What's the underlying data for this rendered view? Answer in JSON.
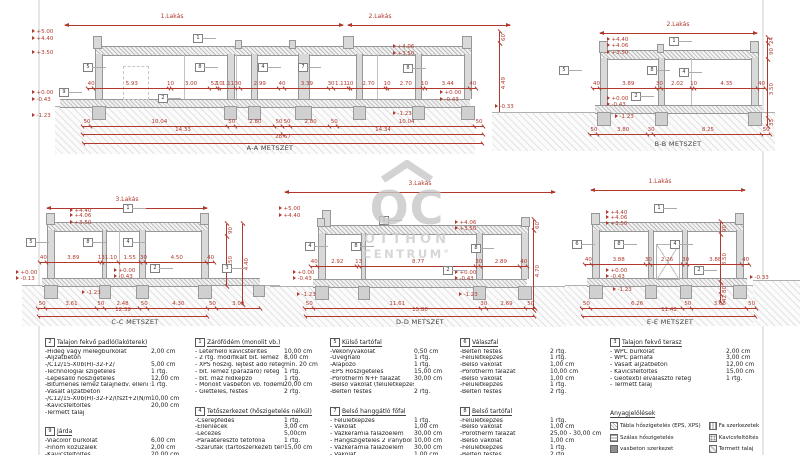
{
  "watermark": {
    "monogram": "OC",
    "line1": "OTTHON",
    "line2": "CENTRUM",
    "reg": "®"
  },
  "sections": {
    "aa": {
      "title": "A-A METSZET",
      "span1": "1.Lakás",
      "span2": "2.Lakás",
      "dims_main": [
        "40",
        "5.93",
        "10",
        "3.00",
        "52",
        "10",
        "1.11",
        "30",
        "2.99",
        "40",
        "3.39",
        "30",
        "1.11",
        "10",
        "2.70",
        "10",
        "2.70",
        "10",
        "3.44",
        "40"
      ],
      "dims_b1": [
        "50",
        "10.04",
        "50",
        "2.80",
        "50",
        "50",
        "2.80",
        "50",
        "10.04",
        "50"
      ],
      "dims_b2": [
        "14.33",
        "14.34"
      ],
      "total": "28.67",
      "vdims": [
        "60",
        "4.49",
        "70",
        "51"
      ],
      "elevs": [
        "+5.00",
        "+4.40",
        "+3.50",
        "+0.00",
        "-0.43",
        "-1.23",
        "+4.06",
        "+3.50",
        "+0.00",
        "-0.43",
        "-1.23"
      ],
      "callouts": [
        "1",
        "5",
        "8",
        "4",
        "7",
        "8",
        "2",
        "9"
      ]
    },
    "bb": {
      "title": "B-B METSZET",
      "span": "2.Lakás",
      "dims_main": [
        "40",
        "3.89",
        "30",
        "2.02",
        "10",
        "4.35",
        "40"
      ],
      "dims_b1": [
        "50",
        "3.80",
        "30",
        "8.25",
        "50"
      ],
      "vdims": [
        "24",
        "90",
        "3.50",
        "35"
      ],
      "elevs": [
        "+4.40",
        "+4.06",
        "+3.50",
        "+0.00",
        "-0.43",
        "-1.23",
        "-0.33"
      ],
      "callouts": [
        "1",
        "5",
        "8",
        "4",
        "2"
      ]
    },
    "cc": {
      "title": "C-C METSZET",
      "span": "3.Lakás",
      "dims_main": [
        "40",
        "3.89",
        "13",
        "1.10",
        "1.55",
        "30",
        "4.50",
        "40"
      ],
      "dims_b1": [
        "50",
        "3.61",
        "50",
        "2.48",
        "50",
        "4.30",
        "50",
        "3.09"
      ],
      "total": "12.39",
      "vdims": [
        "90",
        "3.50"
      ],
      "vdims2": [
        "4.40"
      ],
      "elevs": [
        "+4.40",
        "+4.06",
        "+3.50",
        "+0.00",
        "-0.13",
        "+0.00",
        "-0.43",
        "-1.23"
      ],
      "callouts": [
        "1",
        "5",
        "8",
        "4",
        "2",
        "3"
      ]
    },
    "dd": {
      "title": "D-D METSZET",
      "span": "3.Lakás",
      "dims_main": [
        "40",
        "2.92",
        "13",
        "8.77",
        "30",
        "2.89",
        "40"
      ],
      "dims_b1": [
        "50",
        "11.61",
        "30",
        "2.69",
        "50"
      ],
      "total": "15.80",
      "vdims": [
        "60",
        "4.70"
      ],
      "elevs": [
        "+5.00",
        "+4.40",
        "+4.06",
        "+3.50",
        "+0.00",
        "-0.43",
        "-1.23",
        "+0.00",
        "-0.43",
        "-1.23"
      ],
      "callouts": [
        "1",
        "4",
        "8",
        "8",
        "2"
      ]
    },
    "ee": {
      "title": "E-E METSZET",
      "span": "1.Lakás",
      "dims_main": [
        "40",
        "3.88",
        "30",
        "2.26",
        "30",
        "3.88",
        "40"
      ],
      "dims_b1": [
        "50",
        "6.26",
        "50",
        "3.68",
        "50"
      ],
      "total": "11.42",
      "vdims": [
        "90",
        "3.50",
        "80",
        "42"
      ],
      "elevs": [
        "+4.40",
        "+4.06",
        "+3.50",
        "+0.00",
        "-0.43",
        "-1.23",
        "-0.33"
      ],
      "callouts": [
        "1",
        "6",
        "8",
        "4",
        "2"
      ]
    }
  },
  "legend": {
    "cols": [
      {
        "blocks": [
          {
            "num": "2",
            "title": "Talajon fekvő padló(lakóterek)",
            "rows": [
              {
                "l": "-Hideg vagy melegburkolat",
                "v": "2,00 cm"
              },
              {
                "l": "-Aljzatbeton",
                "v": ""
              },
              {
                "l": "-/C12/15-X0b(H)-32-F2/",
                "v": "5,00 cm"
              },
              {
                "l": "-Technológiai szigetelés",
                "v": "1 rtg."
              },
              {
                "l": "-Lépésálló hőszigetelés",
                "v": "12,00 cm"
              },
              {
                "l": "-Bitumenes lemez talajnedv. elleni szig.",
                "v": "1 rtg."
              },
              {
                "l": "-Vasalt aljzatbeton",
                "v": ""
              },
              {
                "l": "-/C12/15-X0b(H)-32-F2/(fszt+2(N/mm2)",
                "v": "10,00 cm"
              },
              {
                "l": "-Kavicsfeltöltés",
                "v": "20,00 cm"
              },
              {
                "l": "-Termett talaj",
                "v": ""
              }
            ]
          },
          {
            "num": "9",
            "title": "Járda",
            "rows": [
              {
                "l": "-Viacolor burkolat",
                "v": "6,00 cm"
              },
              {
                "l": "-Finom kőzúzalék",
                "v": "2,00 cm"
              },
              {
                "l": "-Kavicsfeltöltés",
                "v": "20,00 cm"
              }
            ]
          }
        ]
      },
      {
        "blocks": [
          {
            "num": "1",
            "title": "Zárófödém (monolit vb.)",
            "rows": [
              {
                "l": "- Leterhelő kavicsterítés",
                "v": "10,00 cm"
              },
              {
                "l": "- 2 rtg. modifikált bit. lemez",
                "v": "8,00 cm"
              },
              {
                "l": "- XPS hőszig. lejtést adó réteg lejtés min. 1%",
                "v": "min. 20 cm"
              },
              {
                "l": "- bit. lemez (párazáró) réteg",
                "v": "1 rtg."
              },
              {
                "l": "- bit. máz hídképző",
                "v": "1 rtg."
              },
              {
                "l": "- Monolit vasbeton vb. födémlemez",
                "v": "20,00 cm"
              },
              {
                "l": "- Glettelés, festés",
                "v": "2 rtg."
              }
            ]
          },
          {
            "num": "4",
            "title": "Tetőszerkezet (hőszigetelés nélkül)",
            "rows": [
              {
                "l": "-Cserépfedés",
                "v": "1 rtg."
              },
              {
                "l": "-Ellenlécek",
                "v": "3,00 cm"
              },
              {
                "l": "-Lécezés",
                "v": "5,00cm"
              },
              {
                "l": "-Páraáteresztő tetőfólia",
                "v": "1 rtg."
              },
              {
                "l": "-Szarufák (tartószerkezeti terv szerint)",
                "v": "15,00 cm"
              }
            ]
          }
        ]
      },
      {
        "blocks": [
          {
            "num": "5",
            "title": "Külső tartófal",
            "rows": [
              {
                "l": "-Vékonyvakolat",
                "v": "0,50 cm"
              },
              {
                "l": "-Üvegháló",
                "v": "1 rtg."
              },
              {
                "l": "-Alapozó",
                "v": "1 rtg."
              },
              {
                "l": "-EPS Hőszigetelés",
                "v": "15,00 cm"
              },
              {
                "l": "-Porotherm N+F falazat",
                "v": "30,00 cm"
              },
              {
                "l": "-Belső vakolat (felületképzéssel)",
                "v": ""
              },
              {
                "l": "-Beltéri festés",
                "v": "2 rtg."
              }
            ]
          },
          {
            "num": "7",
            "title": "Belső hanggátló főfal",
            "rows": [
              {
                "l": "- Felületképzés",
                "v": "1 rtg."
              },
              {
                "l": "- Vakolat",
                "v": "1,00 cm"
              },
              {
                "l": "- Vázkerámia falazóelem",
                "v": "30,00 cm"
              },
              {
                "l": "- Hangszigetelés 2 irányból (10 cm)",
                "v": "10,00 cm"
              },
              {
                "l": "- Vázkerámia falazóelem",
                "v": "30,00 cm"
              },
              {
                "l": "- Vakolat",
                "v": "1,00 cm"
              },
              {
                "l": "- Felületképzés",
                "v": "1 rtg."
              }
            ]
          }
        ]
      },
      {
        "blocks": [
          {
            "num": "6",
            "title": "Válaszfal",
            "rows": [
              {
                "l": "-Beltéri festés",
                "v": "2 rtg."
              },
              {
                "l": "-Felületképzés",
                "v": "1 rtg."
              },
              {
                "l": "-Belső vakolat",
                "v": "1,00 cm"
              },
              {
                "l": "-Porotherm falazat",
                "v": "10,00 cm"
              },
              {
                "l": "-Belső vakolat",
                "v": "1,00 cm"
              },
              {
                "l": "-Felületképzés",
                "v": "1 rtg."
              },
              {
                "l": "-Beltéri festés",
                "v": "2 rtg."
              }
            ]
          },
          {
            "num": "8",
            "title": "Belső tartófal",
            "rows": [
              {
                "l": "-Felületképzés",
                "v": "1 rtg."
              },
              {
                "l": "-Belső vakolat",
                "v": "1,00 cm"
              },
              {
                "l": "-Porotherm falazat",
                "v": "25,00 - 30,00 cm"
              },
              {
                "l": "-Belső vakolat",
                "v": "1,00 cm"
              },
              {
                "l": "-Felületképzés",
                "v": "1 rtg."
              },
              {
                "l": "-Beltéri festés",
                "v": "2 rtg."
              }
            ]
          }
        ]
      },
      {
        "blocks": [
          {
            "num": "3",
            "title": "Talajon fekvő terasz",
            "rows": [
              {
                "l": "- WPC burkolat",
                "v": "2,00 cm"
              },
              {
                "l": "- WPC párnafa",
                "v": "3,00 cm"
              },
              {
                "l": "- Vasalt aljzatbeton",
                "v": "12,00 cm"
              },
              {
                "l": "- Kavicsfeltöltés",
                "v": "15,00 cm"
              },
              {
                "l": "- Geotextil elválasztó réteg",
                "v": "1 rtg."
              },
              {
                "l": "- Termett talaj",
                "v": ""
              }
            ]
          }
        ]
      }
    ]
  },
  "materials": {
    "title": "Anyagjelölések",
    "col1": [
      {
        "t": "Tábla hőszigetelés (EPS, XPS)",
        "k": "board"
      },
      {
        "t": "Szálas hőszigetelés",
        "k": "fiber"
      },
      {
        "t": "vasbeton szerkezet",
        "k": "rc"
      },
      {
        "t": "Vázkerámia falazat",
        "k": "clay"
      }
    ],
    "col2": [
      {
        "t": "Fa szerkezetek",
        "k": "wood"
      },
      {
        "t": "Kavicsfeltöltés",
        "k": "gravel"
      },
      {
        "t": "Termett talaj",
        "k": "soil"
      },
      {
        "t": "Homokágyazat",
        "k": "sand"
      }
    ]
  }
}
